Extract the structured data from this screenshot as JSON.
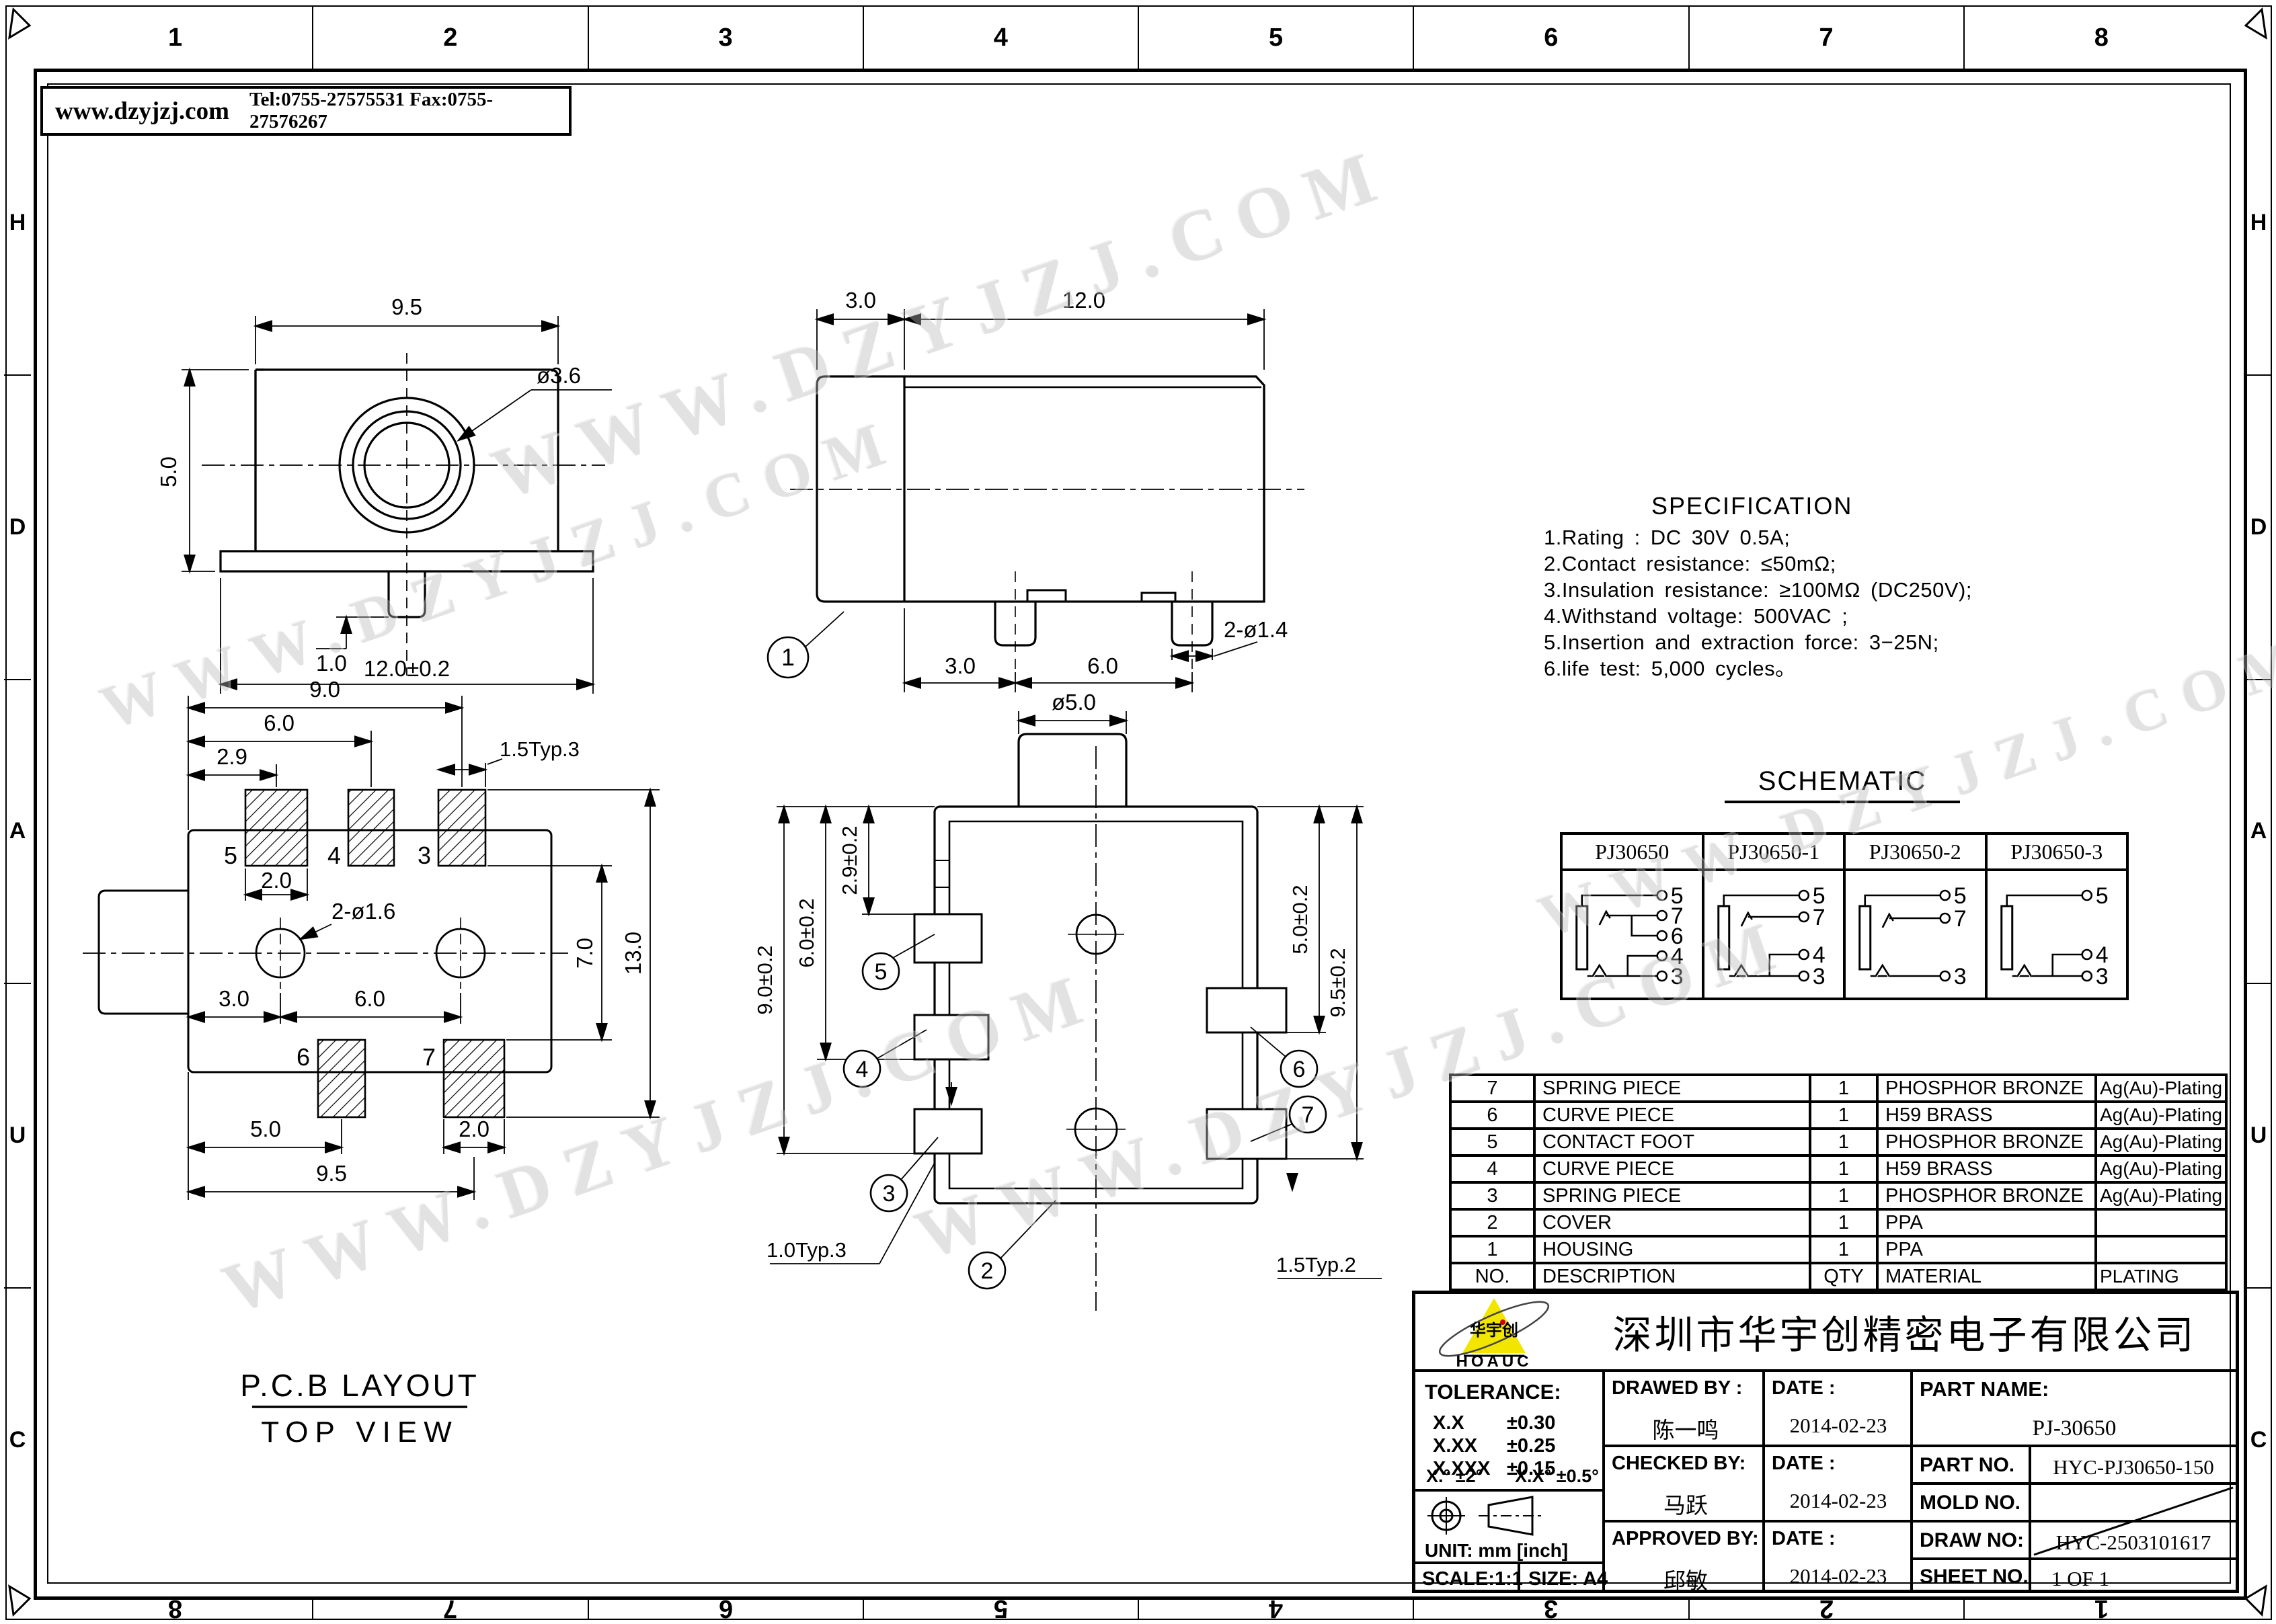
{
  "header_box": {
    "website": "www.dzyjzj.com",
    "contact": "Tel:0755-27575531  Fax:0755-27576267"
  },
  "frame": {
    "top": [
      "1",
      "2",
      "3",
      "4",
      "5",
      "6",
      "7",
      "8"
    ],
    "bottom": [
      "8",
      "7",
      "6",
      "5",
      "4",
      "3",
      "2",
      "1"
    ],
    "left": [
      "H",
      "D",
      "A",
      "U",
      "C"
    ],
    "right": [
      "H",
      "D",
      "A",
      "U",
      "C"
    ]
  },
  "watermark": {
    "text": "WWW.DZYJZJ.COM"
  },
  "front_view": {
    "width_top": "9.5",
    "height_left": "5.0",
    "hole_dia": "ø3.6",
    "peg_offset": "1.0",
    "width_bottom": "12.0±0.2"
  },
  "side_view": {
    "seg_left": "3.0",
    "seg_body": "12.0",
    "legs_label": "2-ø1.4",
    "pitch_a": "3.0",
    "pitch_b": "6.0",
    "balloon_1": "1"
  },
  "top_view": {
    "barrel_dia": "ø5.0",
    "dim_29": "2.9±0.2",
    "dim_60": "6.0±0.2",
    "dim_90": "9.0±0.2",
    "dim_50": "5.0±0.2",
    "dim_95": "9.5±0.2",
    "typ_left": "1.0Typ.3",
    "typ_right": "1.5Typ.2",
    "balloon_2": "2",
    "balloon_3": "3",
    "balloon_4": "4",
    "balloon_5": "5",
    "balloon_6": "6",
    "balloon_7": "7"
  },
  "pcb_layout": {
    "title": "P.C.B LAYOUT",
    "subtitle": "TOP VIEW",
    "dim_90": "9.0",
    "dim_60_top": "6.0",
    "dim_29": "2.9",
    "dim_15typ3": "1.5Typ.3",
    "dim_20_top": "2.0",
    "holes_label": "2-ø1.6",
    "dim_70": "7.0",
    "dim_130": "13.0",
    "dim_30": "3.0",
    "dim_60_mid": "6.0",
    "dim_50": "5.0",
    "dim_20_bot": "2.0",
    "dim_95": "9.5",
    "pad_5": "5",
    "pad_4": "4",
    "pad_3": "3",
    "pad_6": "6",
    "pad_7": "7"
  },
  "specification": {
    "title": "SPECIFICATION",
    "items": [
      "1.Rating : DC 30V 0.5A;",
      "2.Contact resistance: ≤50mΩ;",
      "3.Insulation resistance: ≥100MΩ (DC250V);",
      "4.Withstand voltage: 500VAC ;",
      "5.Insertion and extraction force: 3−25N;",
      "6.life test: 5,000 cycles。"
    ]
  },
  "schematic": {
    "title": "SCHEMATIC",
    "variants": [
      {
        "name": "PJ30650",
        "pins": [
          "5",
          "7",
          "6",
          "4",
          "3"
        ]
      },
      {
        "name": "PJ30650-1",
        "pins": [
          "5",
          "7",
          "4",
          "3"
        ]
      },
      {
        "name": "PJ30650-2",
        "pins": [
          "5",
          "7",
          "3"
        ]
      },
      {
        "name": "PJ30650-3",
        "pins": [
          "5",
          "4",
          "3"
        ]
      }
    ]
  },
  "parts_table": {
    "columns": {
      "no": "NO.",
      "description": "DESCRIPTION",
      "qty": "QTY",
      "material": "MATERIAL",
      "plating": "PLATING"
    },
    "rows": [
      {
        "no": "7",
        "description": "SPRING PIECE",
        "qty": "1",
        "material": "PHOSPHOR BRONZE",
        "plating": "Ag(Au)-Plating"
      },
      {
        "no": "6",
        "description": "CURVE PIECE",
        "qty": "1",
        "material": "H59 BRASS",
        "plating": "Ag(Au)-Plating"
      },
      {
        "no": "5",
        "description": "CONTACT FOOT",
        "qty": "1",
        "material": "PHOSPHOR BRONZE",
        "plating": "Ag(Au)-Plating"
      },
      {
        "no": "4",
        "description": "CURVE PIECE",
        "qty": "1",
        "material": "H59 BRASS",
        "plating": "Ag(Au)-Plating"
      },
      {
        "no": "3",
        "description": "SPRING PIECE",
        "qty": "1",
        "material": "PHOSPHOR BRONZE",
        "plating": "Ag(Au)-Plating"
      },
      {
        "no": "2",
        "description": "COVER",
        "qty": "1",
        "material": "PPA",
        "plating": ""
      },
      {
        "no": "1",
        "description": "HOUSING",
        "qty": "1",
        "material": "PPA",
        "plating": ""
      }
    ]
  },
  "title_block": {
    "company": "深圳市华宇创精密电子有限公司",
    "logo": {
      "mark": "华宇创",
      "name": "HOAUC"
    },
    "tolerance": {
      "title": "TOLERANCE:",
      "rows": [
        {
          "k": "X.X",
          "v": "±0.30"
        },
        {
          "k": "X.XX",
          "v": "±0.25"
        },
        {
          "k": "X.XXX",
          "v": "±0.15"
        }
      ],
      "angle_a": "X.° ±2°",
      "angle_b": "X.X° ±0.5°"
    },
    "unit": "UNIT: mm [inch]",
    "scale": "SCALE:1:1",
    "size": "SIZE: A4",
    "signoff": {
      "drawn_label": "DRAWED BY :",
      "drawn_name": "陈一鸣",
      "checked_label": "CHECKED BY:",
      "checked_name": "马跃",
      "approved_label": "APPROVED BY:",
      "approved_name": "邱敏",
      "date_label": "DATE :",
      "date_1": "2014-02-23",
      "date_2": "2014-02-23",
      "date_3": "2014-02-23"
    },
    "fields": {
      "part_name_label": "PART NAME:",
      "part_name": "PJ-30650",
      "part_no_label": "PART NO.",
      "part_no": "HYC-PJ30650-150",
      "mold_no_label": "MOLD NO.",
      "draw_no_label": "DRAW NO:",
      "draw_no": "HYC-2503101617",
      "sheet_no_label": "SHEET NO.",
      "sheet_no": "1 OF 1"
    }
  }
}
